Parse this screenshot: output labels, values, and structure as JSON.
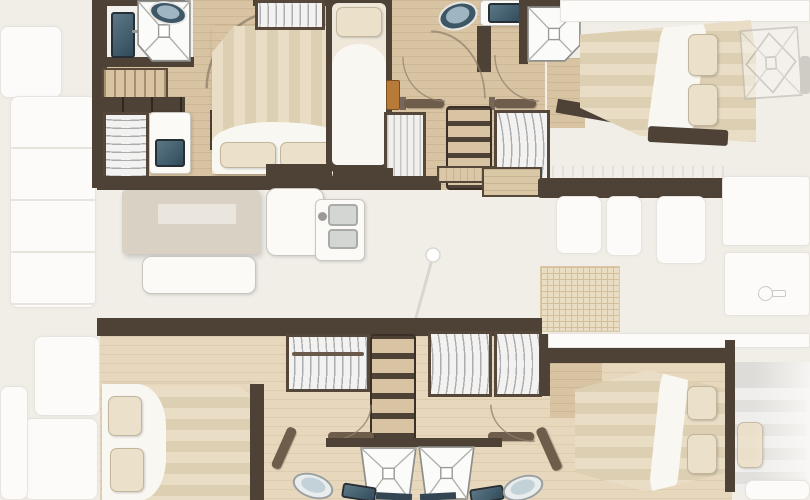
{
  "app": {
    "type": "floorplan-diagram",
    "subject": "catamaran yacht interior layout, top view, bow to the right",
    "aria_label": "Catamaran yacht interior floor plan with four double cabins, two single berths, four bathrooms, saloon and galley"
  },
  "palette": {
    "bg": "#f1eee8",
    "deck_ghost": "#fcfbf9",
    "deck_ghost_line": "#e7e4dd",
    "wood": "#d8c4a2",
    "wood_light": "#e7d8bd",
    "wall_dark": "#4e4136",
    "wall_mid": "#77665a",
    "mattress_stripe_light": "#e9ddc6",
    "mattress_stripe_dark": "#ddcfb2",
    "duvet_white": "#f9f7f2",
    "pillow": "#ebe0c9",
    "fixture_navy": "#44606f",
    "fixture_navy_light": "#a8bcc6",
    "table_top": "#d8d1c4",
    "table_inset": "#eae6de",
    "orange_accent": "#b87a38",
    "trampoline": "#e9dcc1",
    "trampoline_line": "#d3ba92",
    "hanger_line": "#a9adb0"
  },
  "inventory": {
    "double_beds": 4,
    "single_berths": 2,
    "toilets": 4,
    "shower_trays": 4,
    "bathroom_sinks": 4,
    "galley_double_sink": 1,
    "vanity_desk": 1,
    "wardrobes": 7,
    "companionway_steps": 3,
    "saloon_table": 1,
    "saloon_bench": 1,
    "deck_hatch": 1,
    "trampoline_panel": 1,
    "door_swings": 6
  }
}
